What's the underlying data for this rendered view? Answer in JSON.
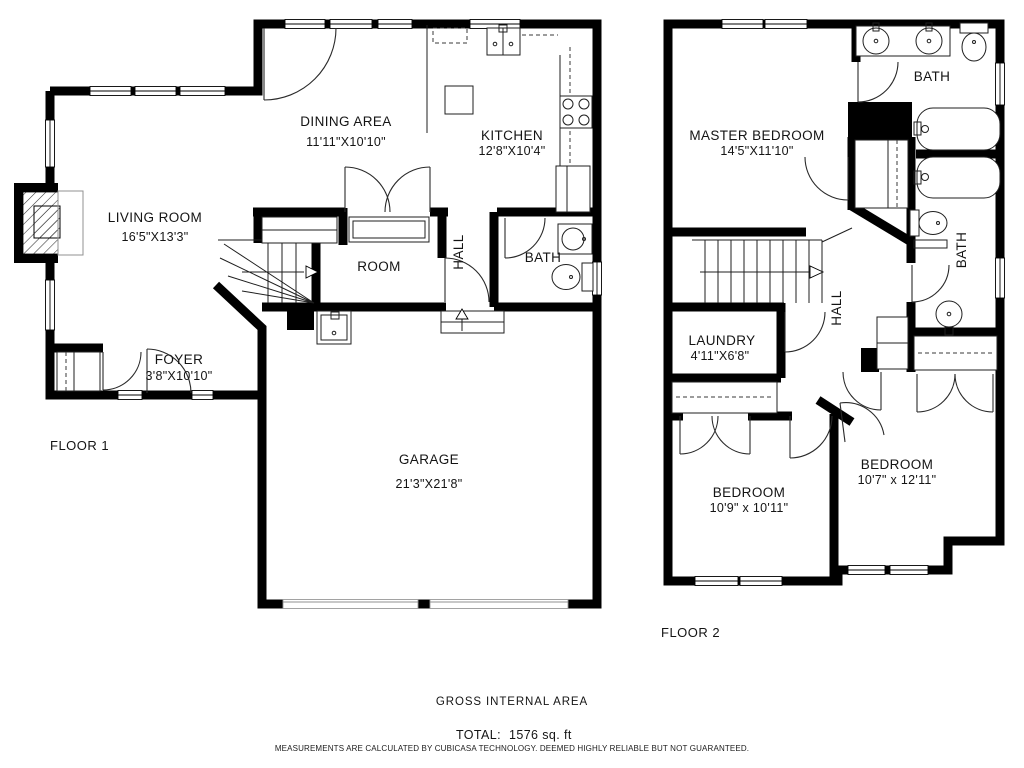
{
  "floor1": {
    "label": "FLOOR 1",
    "rooms": {
      "living": {
        "name": "LIVING ROOM",
        "dims": "16'5\"X13'3\""
      },
      "dining": {
        "name": "DINING AREA",
        "dims": "11'11\"X10'10\""
      },
      "kitchen": {
        "name": "KITCHEN",
        "dims": "12'8\"X10'4\""
      },
      "room": {
        "name": "ROOM"
      },
      "hall": {
        "name": "HALL"
      },
      "bath": {
        "name": "BATH"
      },
      "foyer": {
        "name": "FOYER",
        "dims": "3'8\"X10'10\""
      },
      "garage": {
        "name": "GARAGE",
        "dims": "21'3\"X21'8\""
      }
    }
  },
  "floor2": {
    "label": "FLOOR 2",
    "rooms": {
      "master": {
        "name": "MASTER BEDROOM",
        "dims": "14'5\"X11'10\""
      },
      "bath_top": {
        "name": "BATH"
      },
      "bath_side": {
        "name": "BATH"
      },
      "hall": {
        "name": "HALL"
      },
      "laundry": {
        "name": "LAUNDRY",
        "dims": "4'11\"X6'8\""
      },
      "bedroom_left": {
        "name": "BEDROOM",
        "dims": "10'9\" x 10'11\""
      },
      "bedroom_right": {
        "name": "BEDROOM",
        "dims": "10'7\" x 12'11\""
      }
    }
  },
  "footer": {
    "area_title": "GROSS INTERNAL AREA",
    "total_label": "TOTAL:",
    "total_value": "1576  sq. ft",
    "disclaimer": "MEASUREMENTS ARE CALCULATED BY CUBICASA TECHNOLOGY. DEEMED HIGHLY RELIABLE BUT NOT GUARANTEED."
  },
  "colors": {
    "wall": "#000000",
    "background": "#ffffff"
  }
}
